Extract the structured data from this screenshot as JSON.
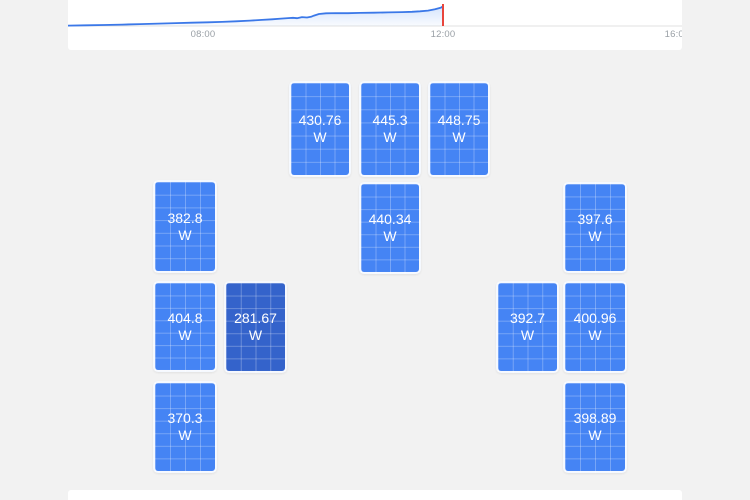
{
  "app": {
    "page_background": "#f2f2f2",
    "card_background": "#ffffff"
  },
  "production_chart": {
    "type": "area",
    "time_axis_labels": [
      {
        "text": "08:00",
        "x": 203
      },
      {
        "text": "12:00",
        "x": 443
      },
      {
        "text": "16:00",
        "x": 677
      }
    ],
    "axis_label_color": "#9aa0a6",
    "baseline_y": 26,
    "baseline_color": "#e0e0e0",
    "line_color": "#3b78e8",
    "fill_color_top": "rgba(66,133,244,0.22)",
    "fill_color_bottom": "rgba(66,133,244,0.03)",
    "cursor": {
      "x": 443,
      "top": 4,
      "color": "#e8453c"
    },
    "points": [
      [
        68,
        25.6
      ],
      [
        86,
        25.3
      ],
      [
        104,
        25.0
      ],
      [
        122,
        24.6
      ],
      [
        140,
        24.1
      ],
      [
        158,
        23.6
      ],
      [
        176,
        23.1
      ],
      [
        192,
        22.7
      ],
      [
        208,
        22.3
      ],
      [
        222,
        21.9
      ],
      [
        236,
        21.3
      ],
      [
        250,
        20.6
      ],
      [
        262,
        19.9
      ],
      [
        272,
        19.3
      ],
      [
        281,
        18.6
      ],
      [
        288,
        18.1
      ],
      [
        293,
        17.8
      ],
      [
        297,
        18.2
      ],
      [
        302,
        17.1
      ],
      [
        307,
        17.5
      ],
      [
        311,
        16.8
      ],
      [
        314,
        15.6
      ],
      [
        319,
        14.0
      ],
      [
        326,
        13.3
      ],
      [
        336,
        13.1
      ],
      [
        348,
        13.2
      ],
      [
        360,
        12.9
      ],
      [
        374,
        12.7
      ],
      [
        388,
        12.4
      ],
      [
        402,
        12.1
      ],
      [
        412,
        11.8
      ],
      [
        420,
        11.3
      ],
      [
        428,
        10.6
      ],
      [
        435,
        9.3
      ],
      [
        441,
        7.6
      ],
      [
        443,
        6.2
      ]
    ]
  },
  "solar_array": {
    "panel_color": "#4584f4",
    "panel_color_dim": "#3463cb",
    "grid_line_color": "rgba(255,255,255,0.27)",
    "panels": [
      {
        "value": "430.76",
        "unit": "W",
        "x": 289,
        "y": 31,
        "w": 62,
        "h": 96,
        "variant": "normal"
      },
      {
        "value": "445.3",
        "unit": "W",
        "x": 359,
        "y": 31,
        "w": 62,
        "h": 96,
        "variant": "normal"
      },
      {
        "value": "448.75",
        "unit": "W",
        "x": 428,
        "y": 31,
        "w": 62,
        "h": 96,
        "variant": "normal"
      },
      {
        "value": "440.34",
        "unit": "W",
        "x": 359,
        "y": 132,
        "w": 62,
        "h": 92,
        "variant": "normal"
      },
      {
        "value": "382.8",
        "unit": "W",
        "x": 153,
        "y": 130,
        "w": 64,
        "h": 93,
        "variant": "normal"
      },
      {
        "value": "404.8",
        "unit": "W",
        "x": 153,
        "y": 231,
        "w": 64,
        "h": 91,
        "variant": "normal"
      },
      {
        "value": "281.67",
        "unit": "W",
        "x": 224,
        "y": 231,
        "w": 63,
        "h": 92,
        "variant": "dim"
      },
      {
        "value": "370.3",
        "unit": "W",
        "x": 153,
        "y": 331,
        "w": 64,
        "h": 92,
        "variant": "normal"
      },
      {
        "value": "397.6",
        "unit": "W",
        "x": 563,
        "y": 132,
        "w": 64,
        "h": 91,
        "variant": "normal"
      },
      {
        "value": "392.7",
        "unit": "W",
        "x": 496,
        "y": 231,
        "w": 63,
        "h": 92,
        "variant": "normal"
      },
      {
        "value": "400.96",
        "unit": "W",
        "x": 563,
        "y": 231,
        "w": 64,
        "h": 92,
        "variant": "normal"
      },
      {
        "value": "398.89",
        "unit": "W",
        "x": 563,
        "y": 331,
        "w": 64,
        "h": 92,
        "variant": "normal"
      }
    ]
  }
}
